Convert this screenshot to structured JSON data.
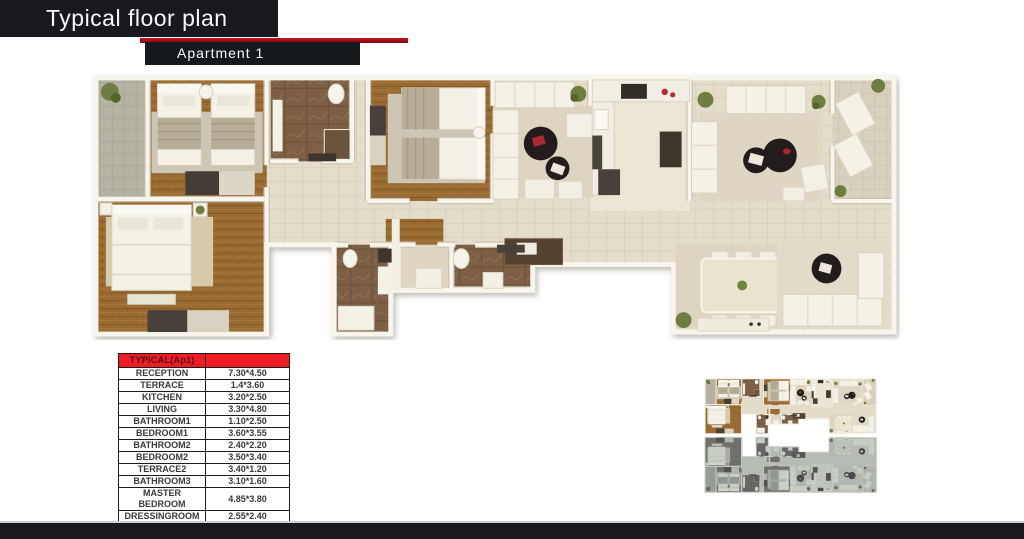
{
  "header": {
    "title": "Typical floor plan",
    "subtitle": "Apartment  1"
  },
  "dimensions_table": {
    "header": "TYPICAL(Ap1)",
    "rows": [
      {
        "room": "RECEPTION",
        "size": "7.30*4.50"
      },
      {
        "room": "TERRACE",
        "size": "1.4*3.60"
      },
      {
        "room": "KITCHEN",
        "size": "3.20*2.50"
      },
      {
        "room": "LIVING",
        "size": "3.30*4.80"
      },
      {
        "room": "BATHROOM1",
        "size": "1.10*2.50"
      },
      {
        "room": "BEDROOM1",
        "size": "3.60*3.55"
      },
      {
        "room": "BATHROOM2",
        "size": "2.40*2.20"
      },
      {
        "room": "BEDROOM2",
        "size": "3.50*3.40"
      },
      {
        "room": "TERRACE2",
        "size": "3.40*1.20"
      },
      {
        "room": "BATHROOM3",
        "size": "3.10*1.60"
      },
      {
        "room": "MASTER BEDROOM",
        "size": "4.85*3.80"
      },
      {
        "room": "DRESSINGROOM",
        "size": "2.55*2.40"
      }
    ]
  },
  "colors": {
    "accent_red": "#c5121d",
    "header_bar": "#17191e",
    "table_header_red": "#ee1c24",
    "wood_floor": "#9a6c33",
    "tile_floor": "#e4ddc9",
    "stone_terrace": "#b6b2a4",
    "marble_bathroom": "#7b5f45",
    "wall": "#f8f5ed",
    "thumbnail_inactive_tint": "#a9b5a1"
  }
}
